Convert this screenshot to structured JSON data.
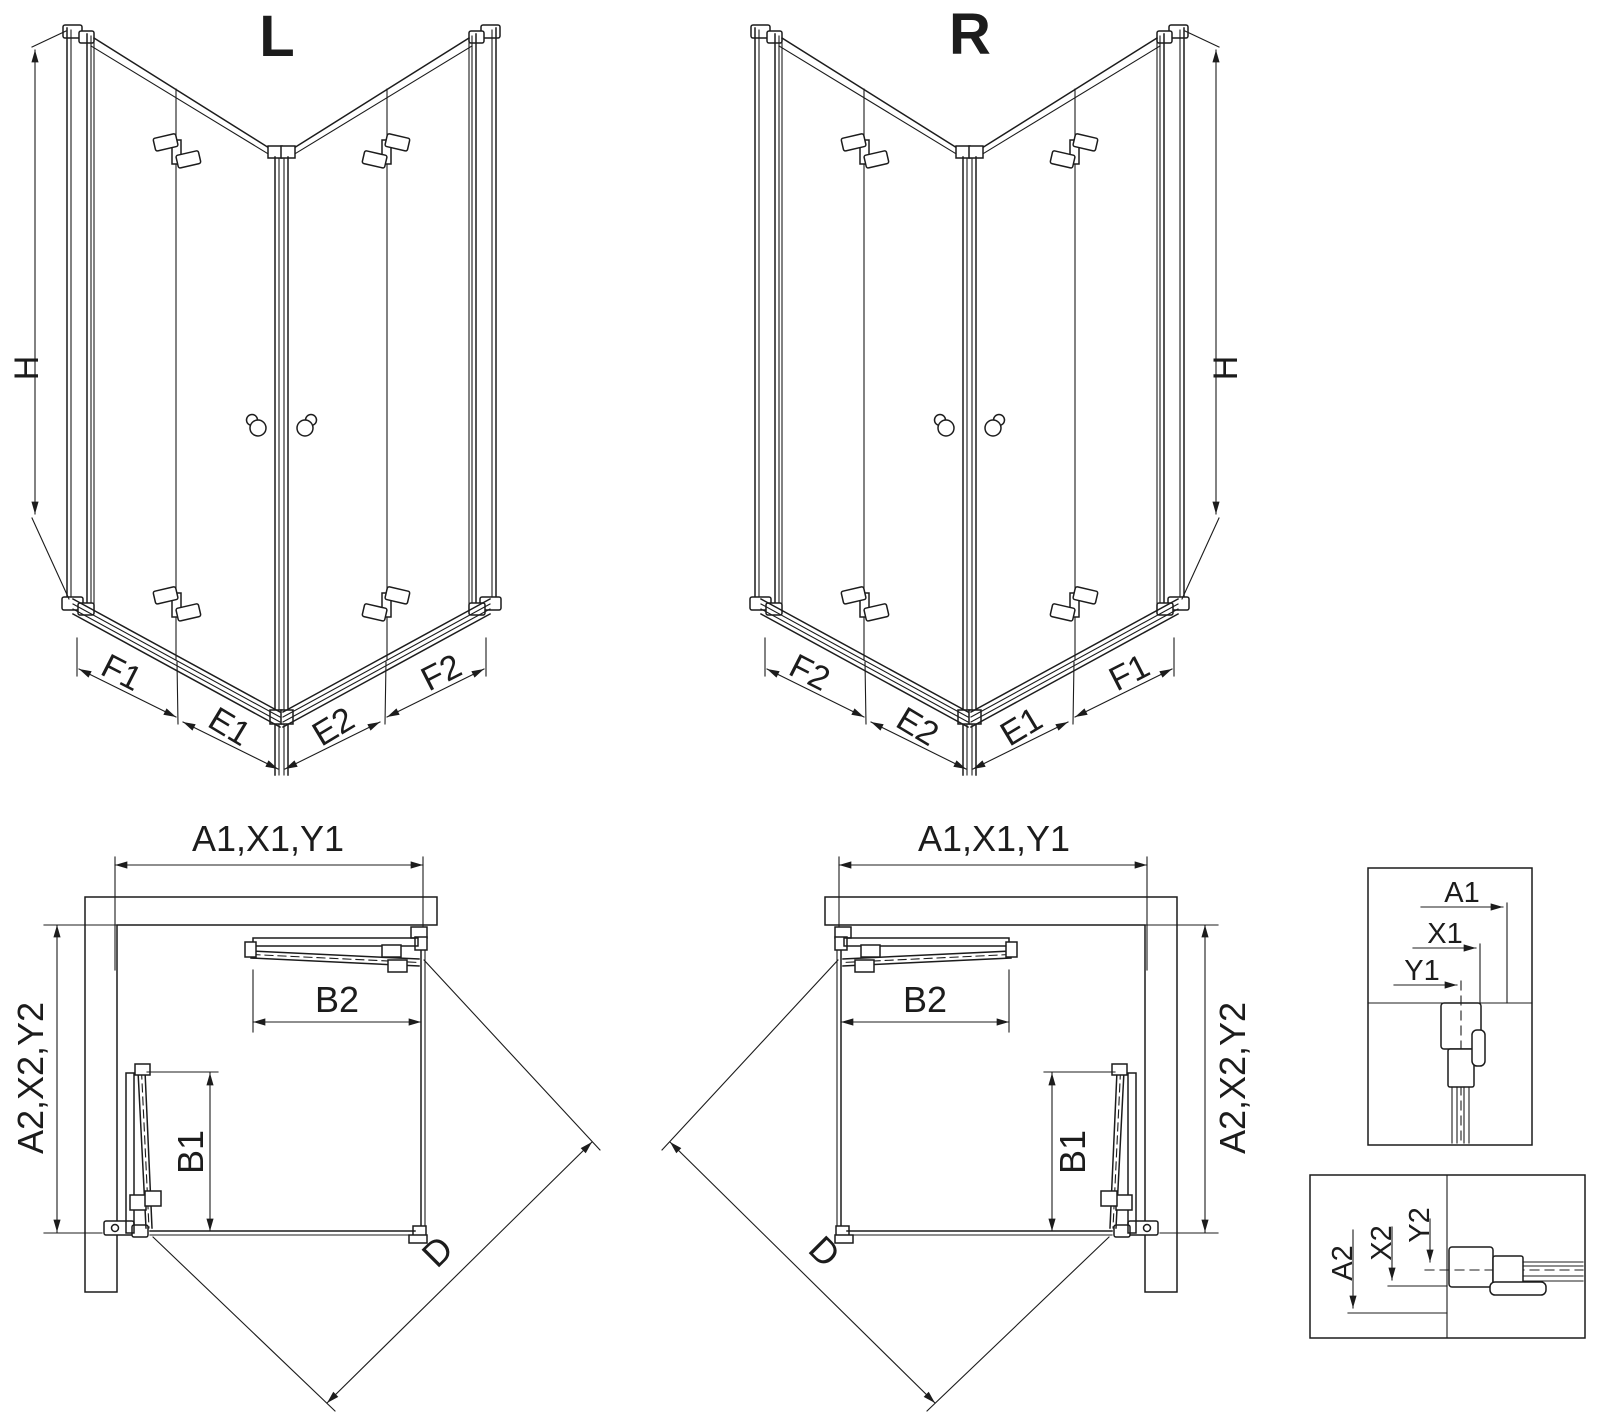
{
  "page": {
    "background": "#ffffff",
    "line_color": "#1c1c1c"
  },
  "views": {
    "front_l": {
      "title": "L",
      "height": "H",
      "f1": "F1",
      "e1": "E1",
      "e2": "E2",
      "f2": "F2"
    },
    "front_r": {
      "title": "R",
      "height": "H",
      "f2": "F2",
      "e2": "E2",
      "e1": "E1",
      "f1": "F1"
    },
    "plan_l": {
      "width": "A1,X1,Y1",
      "depth": "A2,X2,Y2",
      "b2": "B2",
      "b1": "B1",
      "d": "D"
    },
    "plan_r": {
      "width": "A1,X1,Y1",
      "depth": "A2,X2,Y2",
      "b2": "B2",
      "b1": "B1",
      "d": "D"
    },
    "detail_top": {
      "a1": "A1",
      "x1": "X1",
      "y1": "Y1"
    },
    "detail_bottom": {
      "a2": "A2",
      "x2": "X2",
      "y2": "Y2"
    }
  }
}
